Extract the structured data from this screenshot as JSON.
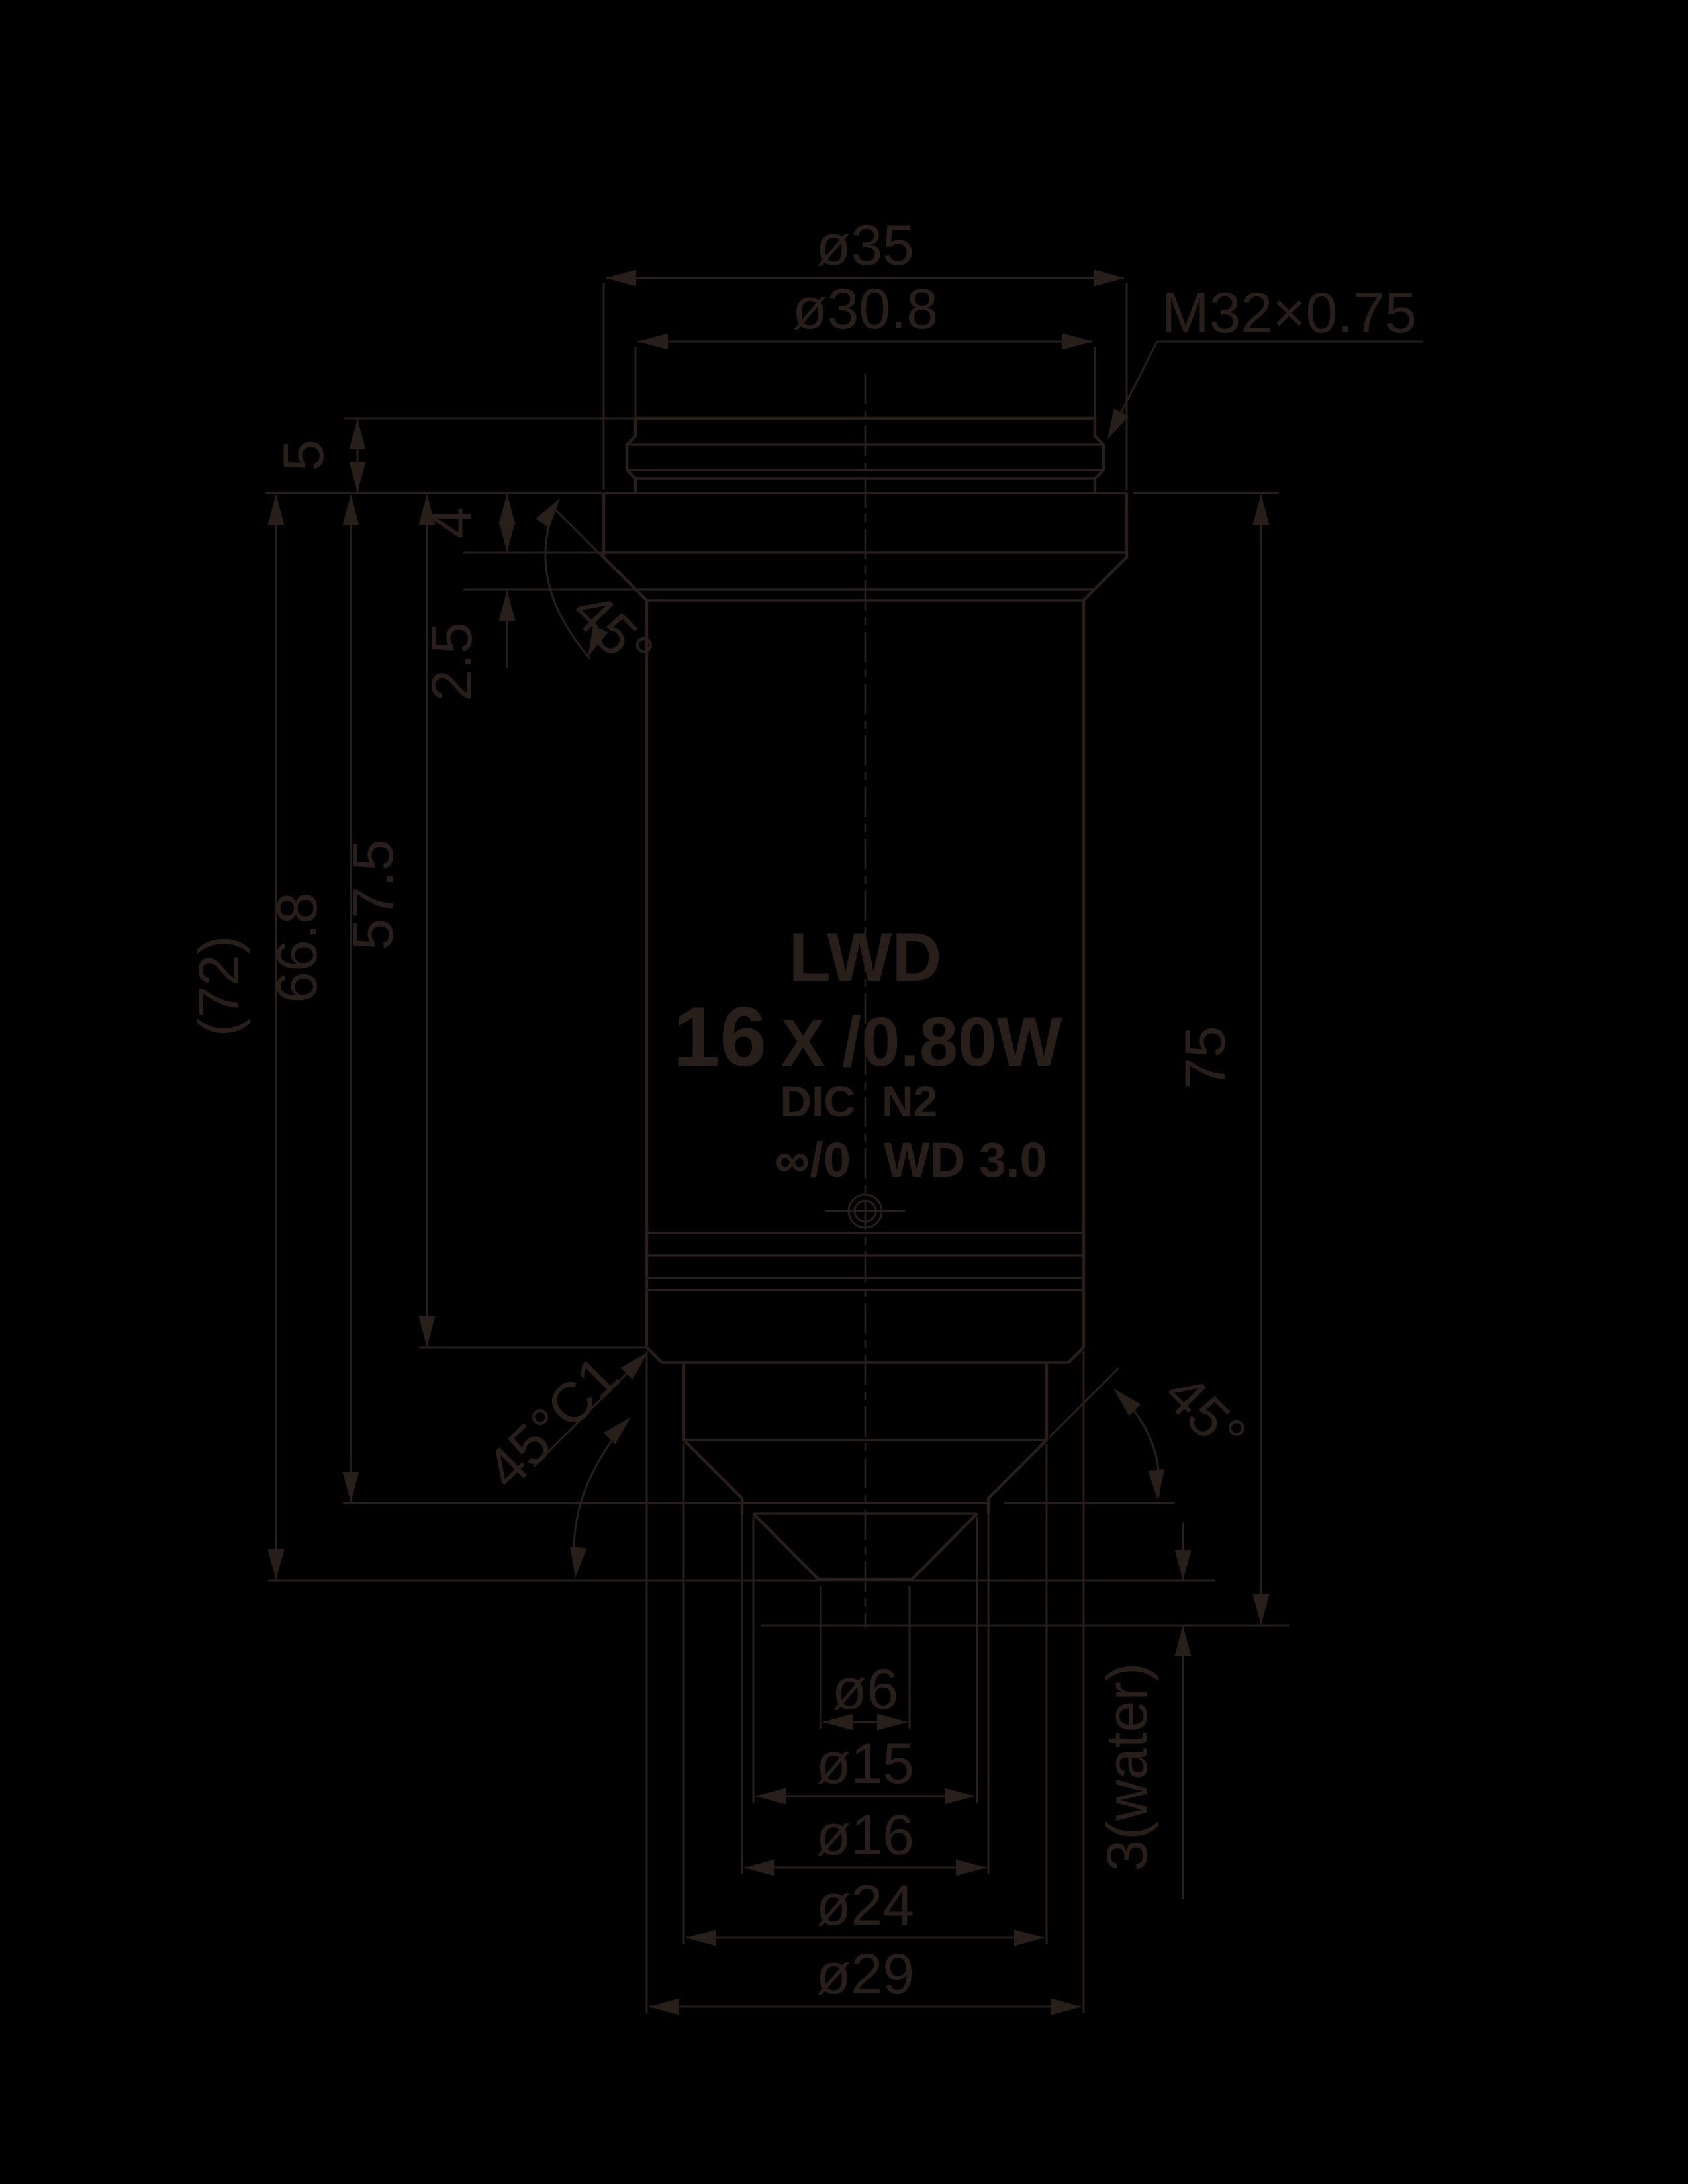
{
  "drawing": {
    "type": "technical-dimension-drawing",
    "subject": "microscope objective lens side elevation",
    "ink_color": "#281e1a",
    "background_color": "#000000"
  },
  "dimensions": {
    "dia35": "ø35",
    "dia30_8": "ø30.8",
    "thread_spec": "M32×0.75",
    "h5": "5",
    "h4": "4",
    "h2_5": "2.5",
    "angle_top": "45°",
    "len72": "(72)",
    "len66_8": "66.8",
    "len57_5": "57.5",
    "len75": "75",
    "chamfer_c1": "45°C1",
    "angle_cone": "45°",
    "dia6": "ø6",
    "dia15": "ø15",
    "dia16": "ø16",
    "dia24": "ø24",
    "dia29": "ø29",
    "working_distance": "3(water)"
  },
  "objective_markings": {
    "series": "LWD",
    "magnification": "16",
    "mag_x": "X",
    "na_spec": "/0.80W",
    "contrast": "DIC",
    "nosepiece_code": "N2",
    "tube_length": "∞/0",
    "working_distance_label": "WD  3.0"
  }
}
